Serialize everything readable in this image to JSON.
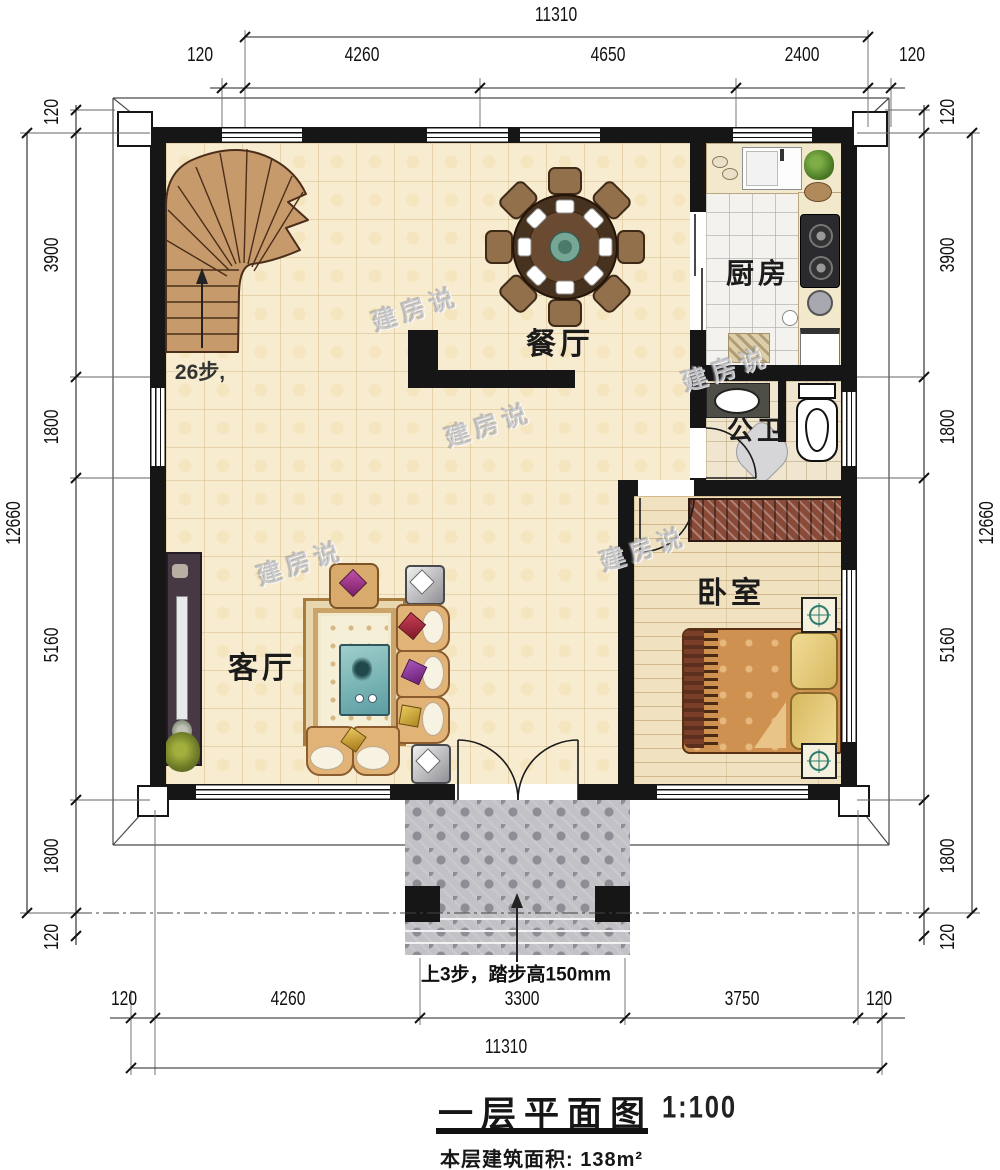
{
  "title": {
    "name": "一层平面图",
    "scale": "1:100",
    "area_label": "本层建筑面积:",
    "area_value": "138m²"
  },
  "labels": {
    "living": "客厅",
    "dining": "餐厅",
    "kitchen": "厨房",
    "bath": "公卫",
    "bedroom": "卧室",
    "stairs_steps": "26步,",
    "entrance_note": "上3步，踏步高150mm"
  },
  "watermark": "建房说",
  "dims": {
    "top": {
      "total": "11310",
      "segments": [
        "120",
        "4260",
        "4650",
        "2400",
        "120"
      ]
    },
    "bottom": {
      "total": "11310",
      "segments": [
        "120",
        "4260",
        "3300",
        "3750",
        "120"
      ]
    },
    "left": {
      "total": "12660",
      "segments": [
        "120",
        "3900",
        "1800",
        "5160",
        "1800",
        "120"
      ]
    },
    "right": {
      "total": "12660",
      "segments": [
        "120",
        "3900",
        "1800",
        "5160",
        "1800",
        "120"
      ]
    }
  },
  "colors": {
    "wall": "#161616",
    "floor_tile": "#f8ecd0",
    "wood_floor": "#f0e2c0",
    "stair": "#c79a6c",
    "porch": "#c1c1c6",
    "table_teal": "#7fb5b0"
  }
}
